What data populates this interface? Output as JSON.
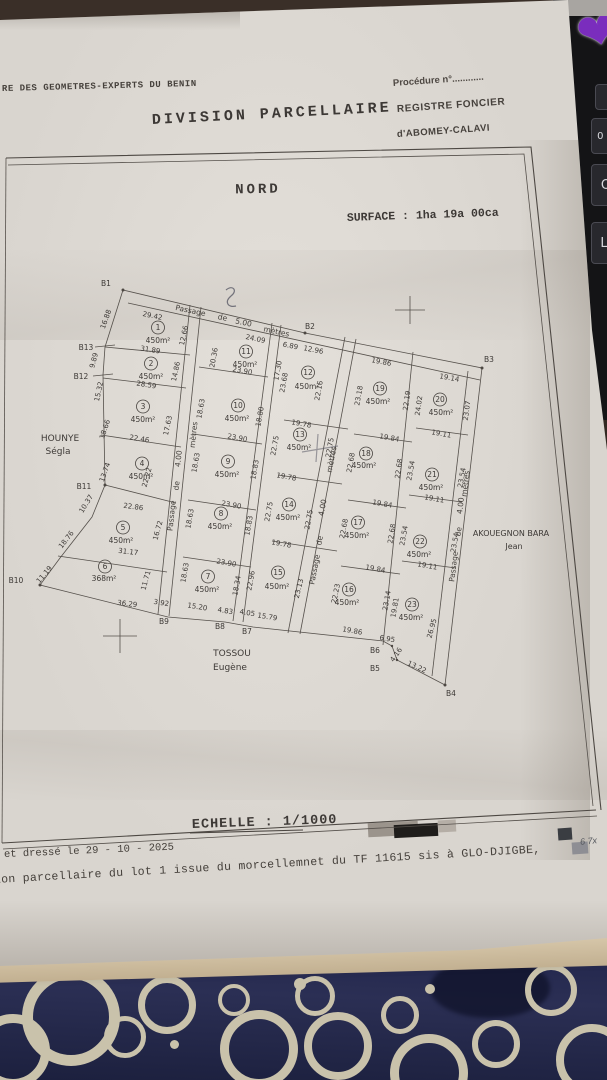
{
  "background": {
    "keyboard_keys": [
      "0 à",
      "O",
      "L"
    ]
  },
  "header": {
    "org_line": "RE DES GEOMETRES-EXPERTS DU BENIN",
    "title": "DIVISION PARCELLAIRE",
    "procedure_label": "Procédure n°............",
    "registre_line1": "REGISTRE FONCIER",
    "registre_line2": "d'ABOMEY-CALAVI"
  },
  "plan": {
    "north_label": "NORD",
    "surface_label": "SURFACE : 1ha 19a 00ca",
    "scale_label": "ECHELLE : 1/1000",
    "names": {
      "west": [
        "HOUNYE",
        "Ségla"
      ],
      "east": [
        "AKOUEGNON BARA",
        "Jean"
      ],
      "south": [
        "TOSSOU",
        "Eugène"
      ]
    },
    "passage_top": [
      "Passage",
      "de",
      "5.00",
      "mètres"
    ],
    "passage_a": [
      "Passage",
      "de",
      "4.00",
      "mètres"
    ],
    "passage_b": [
      "Passage",
      "de",
      "4.00",
      "mètres"
    ],
    "passage_c": [
      "Passage",
      "de",
      "4.00",
      "mètres"
    ],
    "boundary_points": [
      "B1",
      "B2",
      "B3",
      "B4",
      "B5",
      "B6",
      "B7",
      "B8",
      "B9",
      "B10",
      "B11",
      "B12",
      "B13"
    ],
    "lots": [
      {
        "n": "1",
        "a": "450m²"
      },
      {
        "n": "2",
        "a": "450m²"
      },
      {
        "n": "3",
        "a": "450m²"
      },
      {
        "n": "4",
        "a": "450m²"
      },
      {
        "n": "5",
        "a": "450m²"
      },
      {
        "n": "6",
        "a": "368m²"
      },
      {
        "n": "7",
        "a": "450m²"
      },
      {
        "n": "8",
        "a": "450m²"
      },
      {
        "n": "9",
        "a": "450m²"
      },
      {
        "n": "10",
        "a": "450m²"
      },
      {
        "n": "11",
        "a": "450m²"
      },
      {
        "n": "12",
        "a": "450m²"
      },
      {
        "n": "13",
        "a": "450m²"
      },
      {
        "n": "14",
        "a": "450m²"
      },
      {
        "n": "15",
        "a": "450m²"
      },
      {
        "n": "16",
        "a": "450m²"
      },
      {
        "n": "17",
        "a": "450m²"
      },
      {
        "n": "18",
        "a": "450m²"
      },
      {
        "n": "19",
        "a": "450m²"
      },
      {
        "n": "20",
        "a": "450m²"
      },
      {
        "n": "21",
        "a": "450m²"
      },
      {
        "n": "22",
        "a": "450m²"
      },
      {
        "n": "23",
        "a": "450m²"
      }
    ],
    "m": [
      "29.42",
      "24.09",
      "6.89",
      "12.96",
      "19.86",
      "19.14",
      "31.89",
      "28.59",
      "22.46",
      "22.86",
      "31.17",
      "36.29",
      "16.88",
      "9.89",
      "15.32",
      "18.66",
      "13.74",
      "10.37",
      "18.76",
      "11.19",
      "12.66",
      "14.86",
      "17.63",
      "22.22",
      "16.72",
      "11.71",
      "20.36",
      "23.90",
      "18.63",
      "18.80",
      "23.90",
      "18.63",
      "18.83",
      "23.90",
      "18.63",
      "18.83",
      "23.90",
      "18.63",
      "18.34",
      "22.96",
      "17.30",
      "23.68",
      "22.16",
      "19.78",
      "22.75",
      "22.75",
      "19.78",
      "22.75",
      "22.75",
      "19.78",
      "23.13",
      "15.79",
      "23.18",
      "22.19",
      "19.84",
      "22.68",
      "22.68",
      "19.84",
      "22.68",
      "22.68",
      "19.84",
      "22.23",
      "23.14",
      "19.81",
      "19.86",
      "24.02",
      "23.07",
      "19.11",
      "23.54",
      "23.54",
      "19.11",
      "23.54",
      "23.54",
      "19.11",
      "26.95",
      "6.95",
      "4.16",
      "13.22",
      "3.92",
      "15.20",
      "4.83",
      "4.05"
    ]
  },
  "footer": {
    "date_line": "et dressé  le 29 - 10 - 2025",
    "bottom_line": "ion parcellaire du lot 1 issue du morcellemnet du TF 11615 sis à GLO-DJIGBE,",
    "stamp_note": "6 7x"
  }
}
